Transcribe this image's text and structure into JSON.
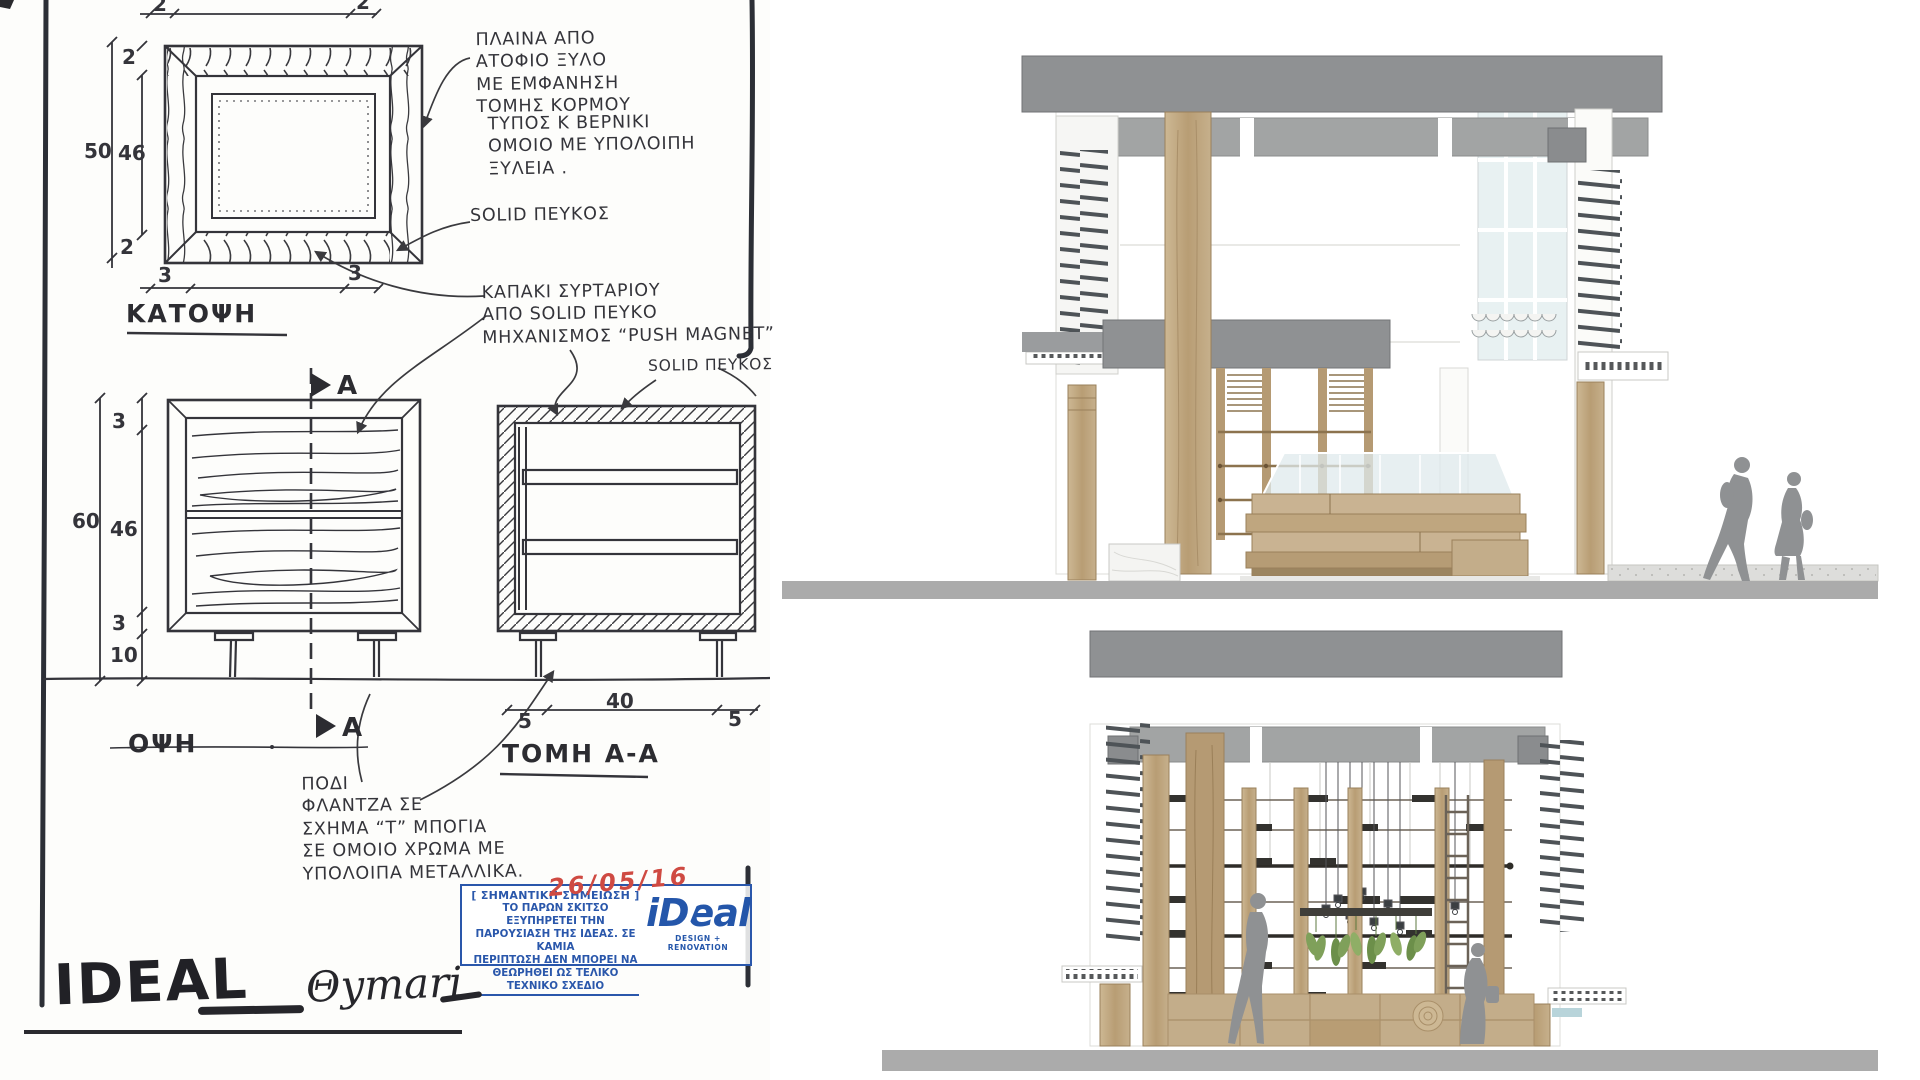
{
  "sketch": {
    "plan": {
      "title": "ΚΑΤΟΨΗ",
      "dims": {
        "top_left": "2",
        "top_right": "2",
        "side_top": "2",
        "side_total": "50",
        "side_inner": "46",
        "side_bottom": "2",
        "bottom_left": "3",
        "bottom_right": "3"
      }
    },
    "elevation": {
      "title": "ΟΨΗ",
      "section_marker": "A",
      "dims": {
        "top": "3",
        "total": "60",
        "inner": "46",
        "bottom": "3",
        "legs": "10"
      }
    },
    "section": {
      "title": "ΤΟΜΗ Α-Α",
      "dims": {
        "left": "5",
        "middle": "40",
        "right": "5"
      }
    },
    "annotations": {
      "sides": "ΠΛΑΙΝΑ ΑΠΟ\nΑΤΟΦΙΟ ΞΥΛΟ\nΜΕ ΕΜΦΑΝΗΣΗ\nΤΟΜΗΣ ΚΟΡΜΟΥ",
      "varnish": "ΤΥΠΟΣ Κ ΒΕΡΝΙΚΙ\nΟΜΟΙΟ ΜΕ ΥΠΟΛΟΙΠΗ\nΞΥΛΕΙΑ .",
      "solid_pine_1": "SOLID ΠΕΥΚΟΣ",
      "drawer": "ΚΑΠΑΚΙ ΣΥΡΤΑΡΙΟΥ\nΑΠΟ SOLID ΠΕΥΚΟ\nΜΗΧΑΝΙΣΜΟΣ “PUSH MAGNET”",
      "solid_pine_2": "SOLID ΠΕΥΚΟΣ",
      "leg": "ΠΟΔΙ\nΦΛΑΝΤΖΑ ΣΕ\nΣΧΗΜΑ “Τ” ΜΠΟΓΙΑ\nΣΕ ΟΜΟΙΟ ΧΡΩΜΑ ΜΕ\nΥΠΟΛΟΙΠΑ ΜΕΤΑΛΛΙΚΑ."
    },
    "stamp": {
      "header": "[ ΣΗΜΑΝΤΙΚΗ ΣΗΜΕΙΩΣΗ ]",
      "date": "26/05/16",
      "body": "ΤΟ ΠΑΡΩΝ ΣΚΙΤΣΟ ΕΞΥΠΗΡΕΤΕΙ ΤΗΝ\nΠΑΡΟΥΣΙΑΣΗ ΤΗΣ ΙΔΕΑΣ. ΣΕ ΚΑΜΙΑ\nΠΕΡΙΠΤΩΣΗ ΔΕΝ ΜΠΟΡΕΙ ΝΑ\nΘΕΩΡΗΘΕΙ ΩΣ ΤΕΛΙΚΟ ΤΕΧΝΙΚΟ ΣΧΕΔΙΟ",
      "logo": "iDeal",
      "logo_tagline": "DESIGN + RENOVATION"
    },
    "signature": {
      "brand": "IDEAL",
      "project": "Θymari"
    }
  },
  "colors": {
    "ink": "#34343a",
    "stamp_blue": "#2a57ab",
    "date_red": "#cf4a42",
    "roof_gray": "#8f9193",
    "soffit_gray": "#a2a4a4",
    "ground_gray": "#ababab",
    "louver_dark": "#4e5357",
    "wood": "#c3ad8a",
    "wood_dark": "#a98f69",
    "glass": "#dfe9ec",
    "figure_gray": "#8f9193",
    "plant_green": "#7fa05a"
  }
}
